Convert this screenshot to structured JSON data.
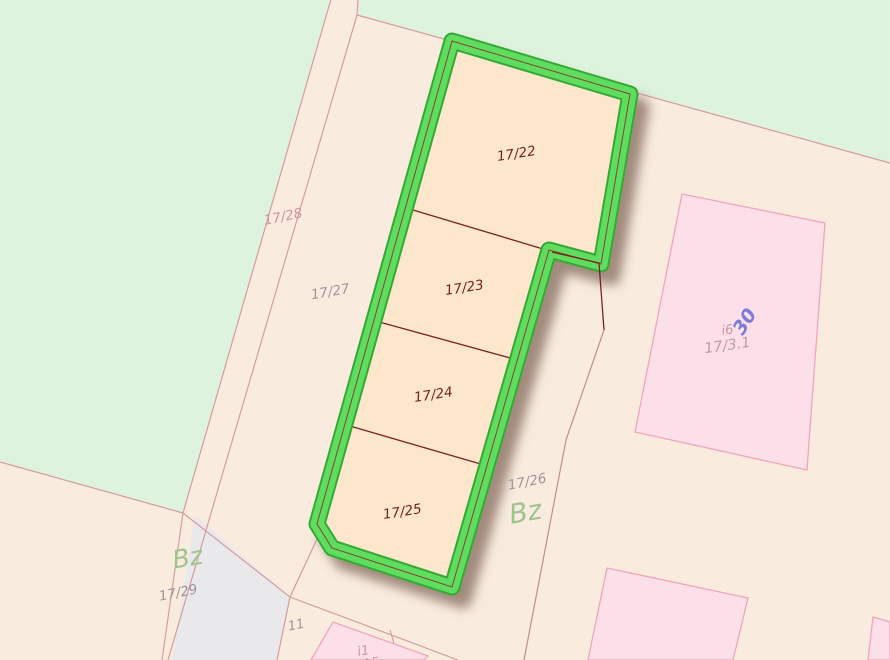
{
  "map": {
    "title": "cadastral-parcel-map",
    "colors": {
      "green_bg": "#def3dd",
      "cream_bg": "#f9ecdf",
      "gray_area": "#e9e8ea",
      "parcel_line": "#d89aa2",
      "boundary_dark": "#7b2022",
      "boundary_mid": "#c08b93",
      "selection_fill": "#fce7cd",
      "selection_border": "#5fdd5f",
      "selection_border_rim": "#35a835",
      "selection_outline_red": "#8b2a2a",
      "building_fill": "#fcdfe8",
      "building_line": "#f2a4bc",
      "label_red": "#7b2022",
      "label_gray": "#9e9399",
      "label_pink": "#d2919f",
      "label_green": "#9cc48c",
      "label_building": "#c898a6",
      "label_blue": "#7a7dd8",
      "shadow": "#6b4f3f"
    },
    "selected_parcels": [
      "17/22",
      "17/23",
      "17/24",
      "17/25"
    ],
    "labels": [
      {
        "id": "parcel-label-17-22",
        "text": "17/22",
        "x": 517,
        "y": 158,
        "rot": -9,
        "size": 13.5,
        "color": "label_red"
      },
      {
        "id": "parcel-label-17-23",
        "text": "17/23",
        "x": 465,
        "y": 292,
        "rot": -9,
        "size": 13.5,
        "color": "label_red"
      },
      {
        "id": "parcel-label-17-24",
        "text": "17/24",
        "x": 434,
        "y": 399,
        "rot": -9,
        "size": 13.5,
        "color": "label_red"
      },
      {
        "id": "parcel-label-17-25",
        "text": "17/25",
        "x": 403,
        "y": 516,
        "rot": -9,
        "size": 13.5,
        "color": "label_red"
      },
      {
        "id": "parcel-label-17-26",
        "text": "17/26",
        "x": 528,
        "y": 486,
        "rot": -11,
        "size": 13.5,
        "color": "label_gray"
      },
      {
        "id": "parcel-label-17-27",
        "text": "17/27",
        "x": 331,
        "y": 296,
        "rot": -10,
        "size": 13.5,
        "color": "label_gray"
      },
      {
        "id": "parcel-label-17-28",
        "text": "17/28",
        "x": 284,
        "y": 221,
        "rot": -12,
        "size": 13.5,
        "color": "label_pink"
      },
      {
        "id": "parcel-label-17-29",
        "text": "17/29",
        "x": 179,
        "y": 597,
        "rot": -11,
        "size": 13.5,
        "color": "label_gray"
      },
      {
        "id": "parcel-label-11",
        "text": "11",
        "x": 297,
        "y": 629,
        "rot": -12,
        "size": 13,
        "color": "label_gray"
      },
      {
        "id": "landuse-label-bz-right",
        "text": "Bz",
        "x": 527,
        "y": 521,
        "rot": -10,
        "size": 27,
        "color": "label_green"
      },
      {
        "id": "landuse-label-bz-left",
        "text": "Bz",
        "x": 189,
        "y": 566,
        "rot": -10,
        "size": 25,
        "color": "label_green"
      },
      {
        "id": "building-label-i6",
        "text": "i6",
        "x": 728,
        "y": 334,
        "rot": -8,
        "size": 13,
        "color": "label_building"
      },
      {
        "id": "building-label-17-3-1",
        "text": "17/3.1",
        "x": 728,
        "y": 350,
        "rot": -8,
        "size": 14.5,
        "color": "label_building"
      },
      {
        "id": "house-number-30",
        "text": "30",
        "x": 750,
        "y": 325,
        "rot": -57,
        "size": 19,
        "color": "label_blue",
        "weight": "600"
      },
      {
        "id": "building-label-i1",
        "text": "i1",
        "x": 364,
        "y": 655,
        "rot": -10,
        "size": 13,
        "color": "label_pink"
      },
      {
        "id": "parcel-label-14-15-partial",
        "text": "14/15",
        "x": 362,
        "y": 669,
        "rot": -10,
        "size": 13,
        "color": "label_pink"
      }
    ]
  }
}
